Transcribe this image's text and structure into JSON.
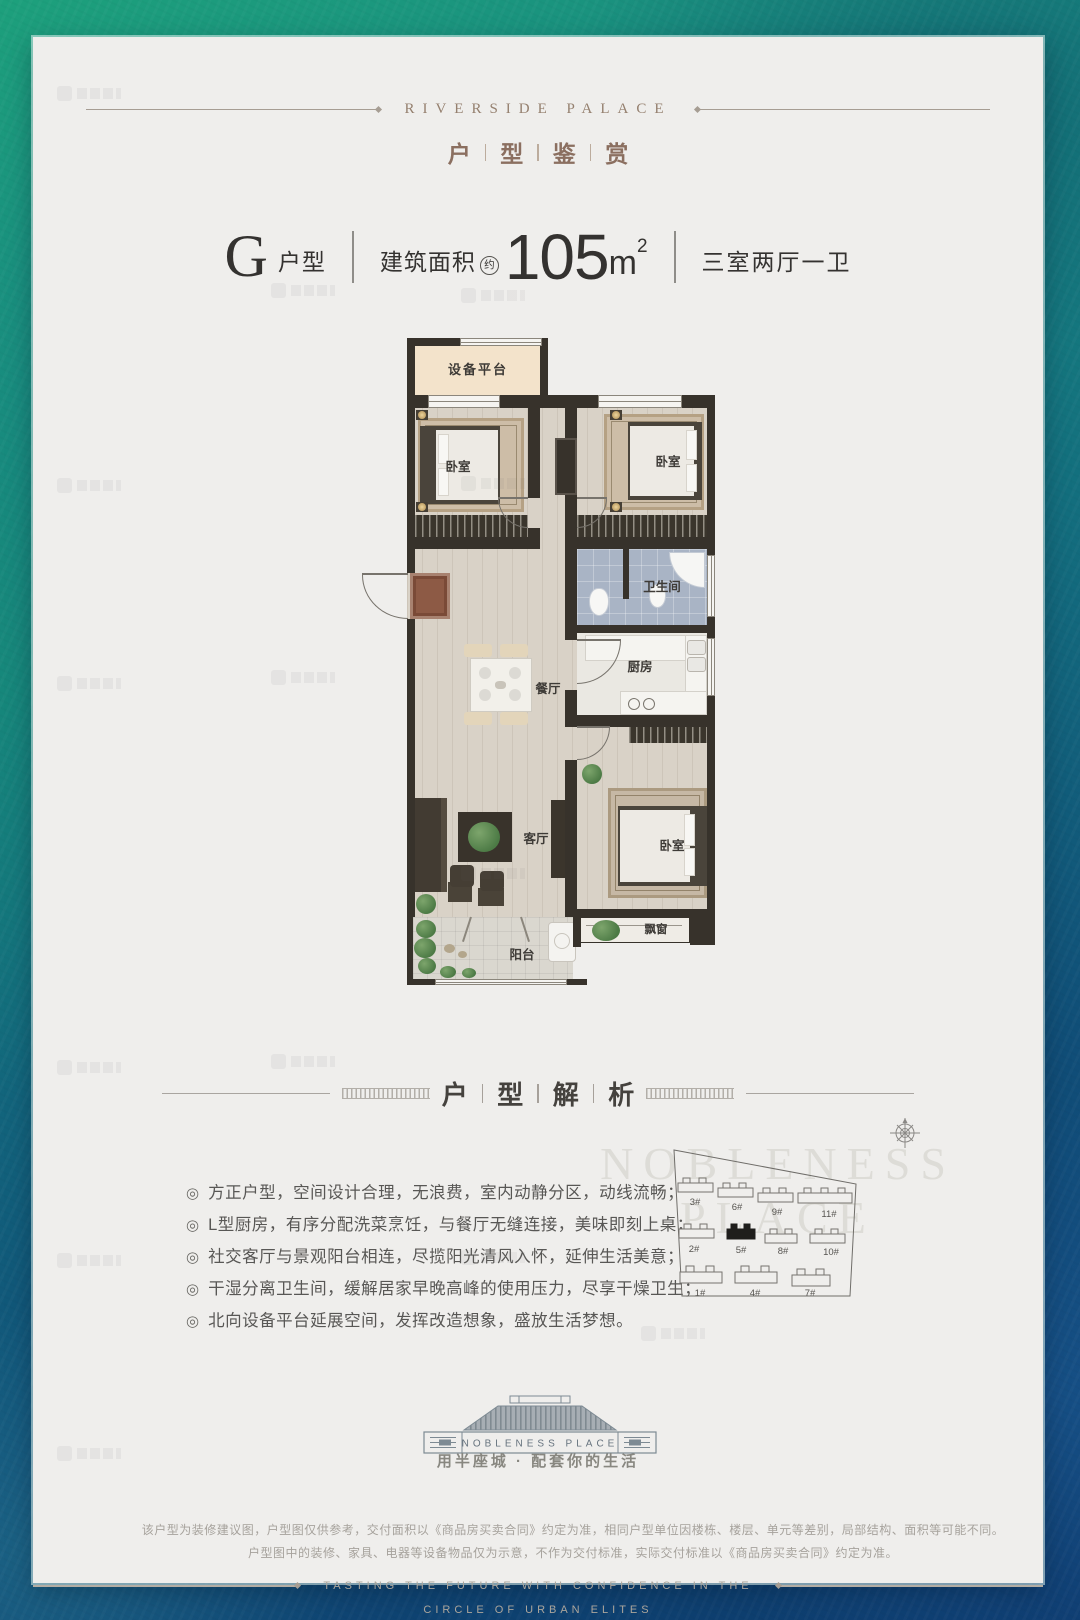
{
  "colors": {
    "border_green": "#1da07c",
    "border_teal": "#136f7e",
    "border_navy": "#0d3a6d",
    "card_bg": "#efeeec",
    "brand_text": "#95806f",
    "section_text": "#8b6f60",
    "dark_text": "#343230",
    "wall": "#37322b",
    "bath_tile": "#a9b4c5",
    "platform_fill": "#f3e3cb",
    "highlight_building": "#1f1e1c"
  },
  "header": {
    "brand": "RIVERSIDE PALACE",
    "section_chars": [
      "户",
      "型",
      "鉴",
      "赏"
    ]
  },
  "unit": {
    "letter": "G",
    "letter_suffix": "户型",
    "area_label": "建筑面积",
    "area_approx": "约",
    "area_value": "105",
    "area_unit": "m",
    "area_exponent": "2",
    "layout_desc": "三室两厅一卫"
  },
  "floorplan": {
    "labels": {
      "platform": "设备平台",
      "bedroom_left": "卧室",
      "bedroom_right": "卧室",
      "bedroom_south": "卧室",
      "bathroom": "卫生间",
      "kitchen": "厨房",
      "dining": "餐厅",
      "living": "客厅",
      "bay_window": "飘窗",
      "balcony": "阳台"
    }
  },
  "analysis": {
    "title_chars": [
      "户",
      "型",
      "解",
      "析"
    ],
    "bullet_marker": "◎",
    "bullets": [
      "方正户型，空间设计合理，无浪费，室内动静分区，动线流畅；",
      "L型厨房，有序分配洗菜烹饪，与餐厅无缝连接，美味即刻上桌；",
      "社交客厅与景观阳台相连，尽揽阳光清风入怀，延伸生活美意；",
      "干湿分离卫生间，缓解居家早晚高峰的使用压力，尽享干燥卫生；",
      "北向设备平台延展空间，发挥改造想象，盛放生活梦想。"
    ]
  },
  "sitemap": {
    "buildings": [
      {
        "label": "3#",
        "highlighted": false
      },
      {
        "label": "6#",
        "highlighted": false
      },
      {
        "label": "9#",
        "highlighted": false
      },
      {
        "label": "11#",
        "highlighted": false
      },
      {
        "label": "2#",
        "highlighted": false
      },
      {
        "label": "5#",
        "highlighted": true
      },
      {
        "label": "8#",
        "highlighted": false
      },
      {
        "label": "10#",
        "highlighted": false
      },
      {
        "label": "1#",
        "highlighted": false
      },
      {
        "label": "4#",
        "highlighted": false
      },
      {
        "label": "7#",
        "highlighted": false
      }
    ],
    "watermark_line1": "NOBLENESS",
    "watermark_line2": "PLACE"
  },
  "footer": {
    "logo_text": "NOBLENESS PLACE",
    "tagline": "用半座城 · 配套你的生活",
    "disclaimer_line1": "该户型为装修建议图，户型图仅供参考，交付面积以《商品房买卖合同》约定为准，相同户型单位因楼栋、楼层、单元等差别，局部结构、面积等可能不同。",
    "disclaimer_line2": "户型图中的装修、家具、电器等设备物品仅为示意，不作为交付标准，实际交付标准以《商品房买卖合同》约定为准。",
    "english_line1": "TASTING THE FUTURE WITH CONFIDENCE IN THE",
    "english_line2": "CIRCLE OF URBAN ELITES"
  }
}
